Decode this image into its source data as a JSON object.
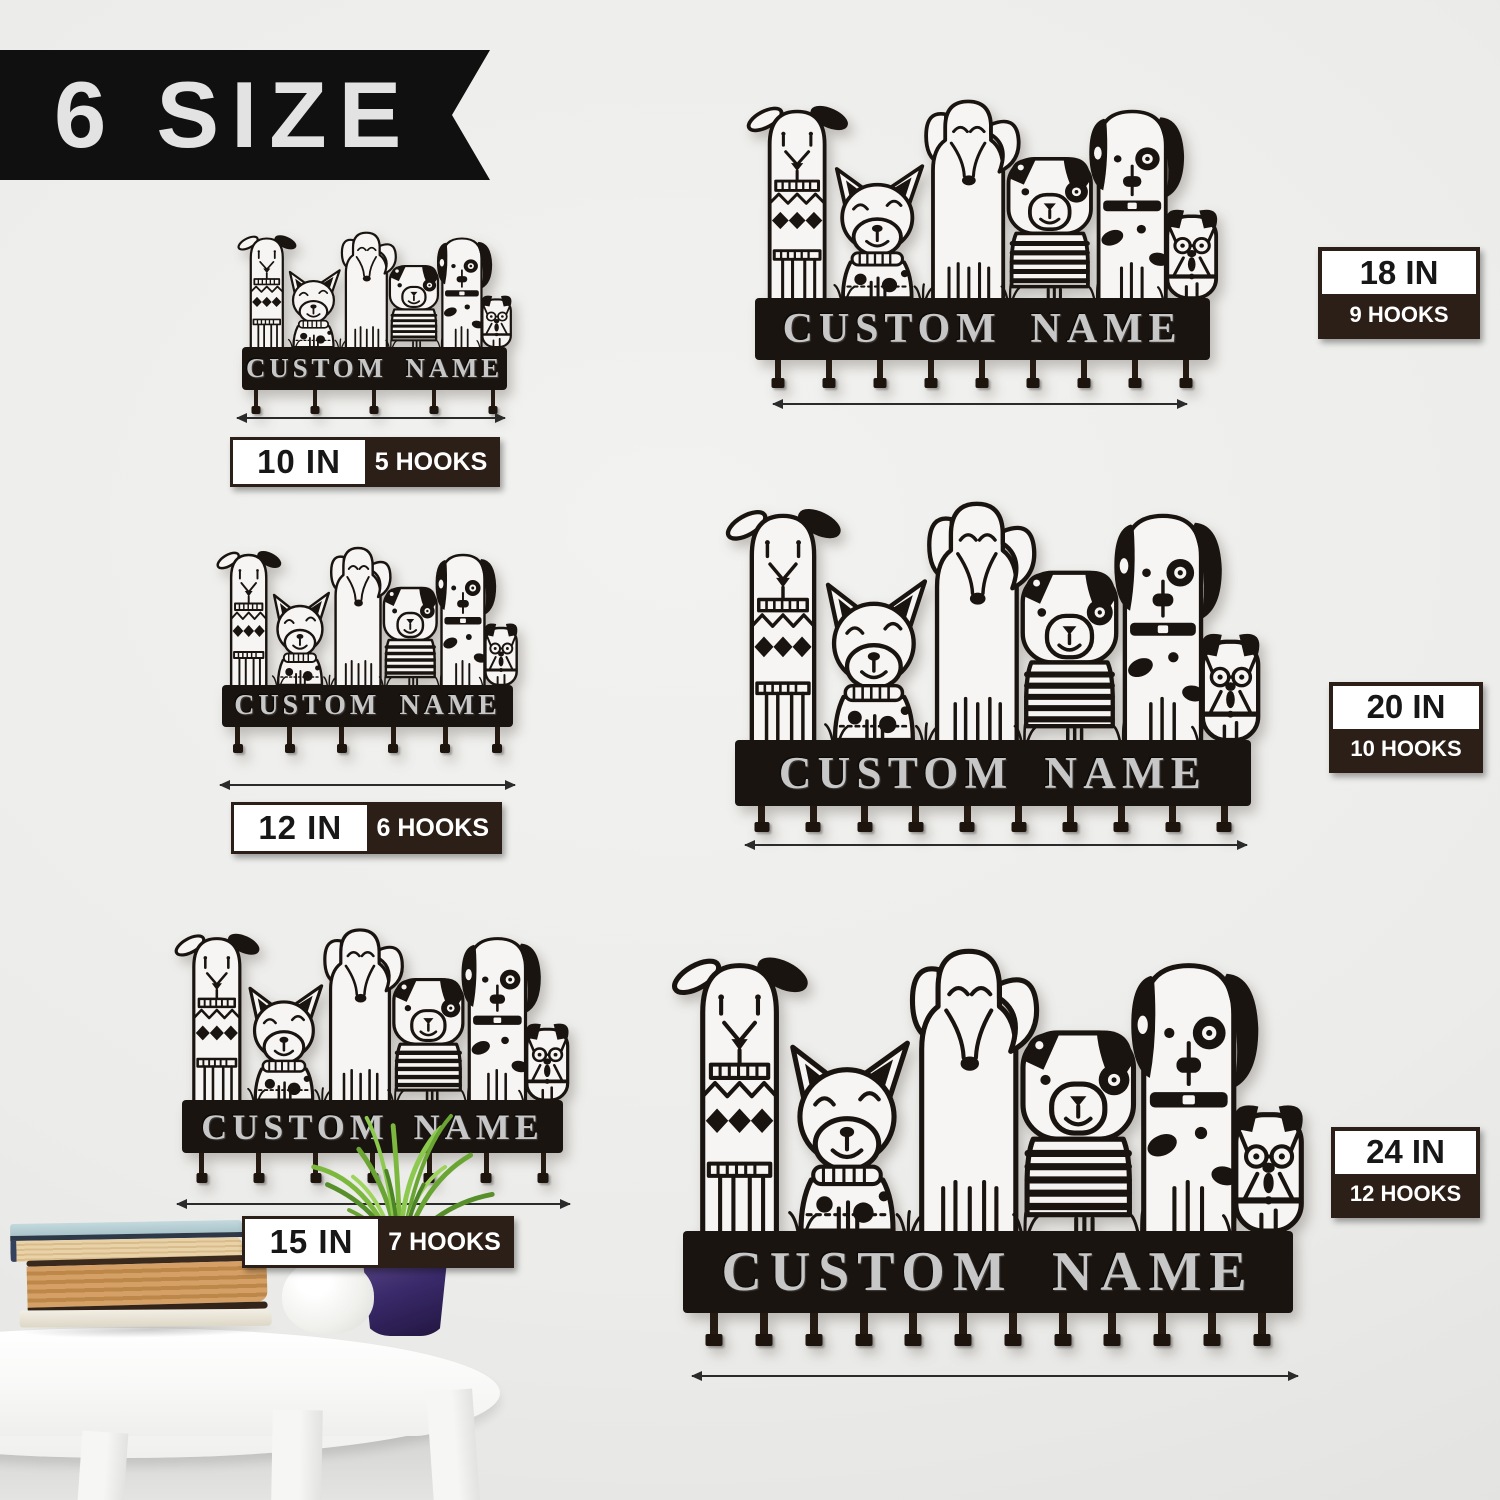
{
  "banner": {
    "label": "6 SIZE"
  },
  "sign": {
    "name_text": "CUSTOM NAME"
  },
  "products": [
    {
      "size": "10 IN",
      "hooks_label": "5 HOOKS",
      "hook_count": 5
    },
    {
      "size": "12 IN",
      "hooks_label": "6 HOOKS",
      "hook_count": 6
    },
    {
      "size": "15 IN",
      "hooks_label": "7 HOOKS",
      "hook_count": 7
    },
    {
      "size": "18 IN",
      "hooks_label": "9 HOOKS",
      "hook_count": 9
    },
    {
      "size": "20 IN",
      "hooks_label": "10 HOOKS",
      "hook_count": 10
    },
    {
      "size": "24 IN",
      "hooks_label": "12 HOOKS",
      "hook_count": 12
    }
  ],
  "colors": {
    "wall": "#ececea",
    "metal_black": "#1a1410",
    "label_dark_brown": "#2b1f17",
    "label_white": "#ffffff",
    "engraved_silver": "#c7c7c7",
    "plant_green": "#7db83e",
    "pot_purple": "#3a2a6b",
    "book_teal_cover": "#b5d0d6",
    "book_tan_pages": "#c8935c"
  },
  "scene": {
    "decor": [
      "stacked-books",
      "white-vase",
      "potted-grass-plant",
      "white-round-table"
    ]
  }
}
